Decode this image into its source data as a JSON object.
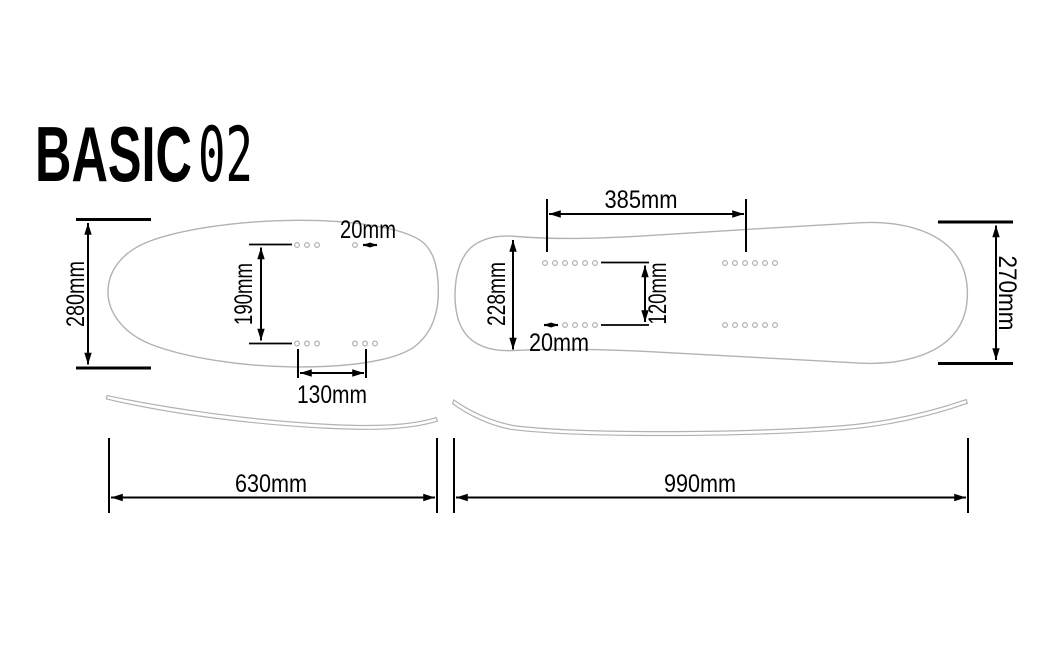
{
  "title": {
    "brand": "BASIC",
    "model": "02"
  },
  "colors": {
    "board_outline": "#b2b2b2",
    "dimension": "#000000",
    "background": "#ffffff"
  },
  "boards": {
    "short_deck": {
      "dims": {
        "overall_width": "280mm",
        "insert_row_gap": "190mm",
        "hole_pitch": "20mm",
        "insert_group_distance": "130mm",
        "overall_length": "630mm"
      }
    },
    "long_deck": {
      "dims": {
        "insert_group_distance": "385mm",
        "nose_width": "228mm",
        "insert_row_gap": "120mm",
        "hole_pitch": "20mm",
        "tail_width": "270mm",
        "overall_length": "990mm"
      }
    }
  }
}
